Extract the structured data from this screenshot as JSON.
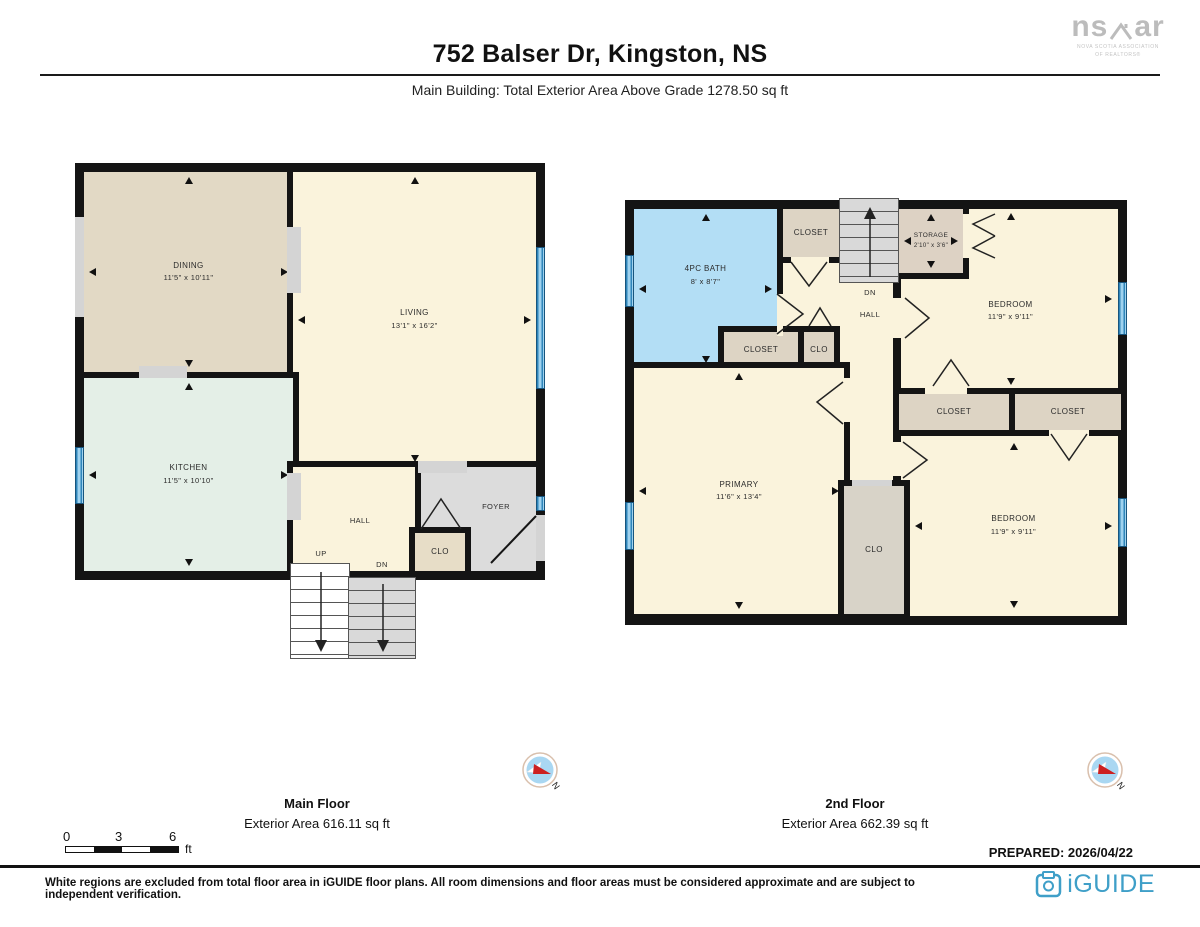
{
  "header": {
    "title": "752 Balser Dr, Kingston, NS",
    "subtitle": "Main Building: Total Exterior Area Above Grade 1278.50 sq ft"
  },
  "branding": {
    "nsar_left": "ns",
    "nsar_right": "ar",
    "nsar_caption1": "NOVA SCOTIA ASSOCIATION",
    "nsar_caption2": "OF REALTORS®",
    "iguide": "iGUIDE"
  },
  "main_floor": {
    "label": "Main Floor",
    "area": "Exterior Area 616.11 sq ft",
    "rooms": {
      "dining": {
        "name": "DINING",
        "dims": "11'5\" x 10'11\""
      },
      "living": {
        "name": "LIVING",
        "dims": "13'1\" x 16'2\""
      },
      "kitchen": {
        "name": "KITCHEN",
        "dims": "11'5\" x 10'10\""
      },
      "hall": {
        "name": "HALL"
      },
      "foyer": {
        "name": "FOYER"
      },
      "closet": {
        "name": "CLO"
      },
      "up": "UP",
      "dn": "DN"
    }
  },
  "second_floor": {
    "label": "2nd Floor",
    "area": "Exterior Area 662.39 sq ft",
    "rooms": {
      "bath": {
        "name": "4PC BATH",
        "dims": "8' x 8'7\""
      },
      "closet_top": {
        "name": "CLOSET"
      },
      "storage": {
        "name": "STORAGE",
        "dims": "2'10\" x 3'6\""
      },
      "bedroom_top": {
        "name": "BEDROOM",
        "dims": "11'9\" x 9'11\""
      },
      "dn": "DN",
      "hall": {
        "name": "HALL"
      },
      "closet_mid": {
        "name": "CLOSET"
      },
      "clo_mid": {
        "name": "CLO"
      },
      "primary": {
        "name": "PRIMARY",
        "dims": "11'6\" x 13'4\""
      },
      "closet_left": {
        "name": "CLOSET"
      },
      "closet_right": {
        "name": "CLOSET"
      },
      "bedroom_bottom": {
        "name": "BEDROOM",
        "dims": "11'9\" x 9'11\""
      },
      "clo_bottom": {
        "name": "CLO"
      }
    }
  },
  "scale_bar": {
    "t0": "0",
    "t3": "3",
    "t6": "6",
    "unit": "ft"
  },
  "compass": {
    "label": "N"
  },
  "footer": {
    "prepared": "PREPARED: 2026/04/22",
    "disclaimer": "White regions are excluded from total floor area in iGUIDE floor plans. All room dimensions and floor areas must be considered approximate and are subject to independent verification."
  },
  "colors": {
    "wall": "#141414",
    "cream": "#faf3dc",
    "dining_tan": "#e2d9c5",
    "kitchen_mint": "#e4efe7",
    "foyer_gray": "#dcdcdc",
    "closet_beige": "#e7ddc7",
    "closet_taupe": "#ddd4c4",
    "bath_blue": "#b3def5",
    "window_blue": "#2f85ba",
    "stairs_gray": "#d9d9d9",
    "iguide_blue": "#3f9fc8",
    "compass_red": "#cc2020"
  }
}
